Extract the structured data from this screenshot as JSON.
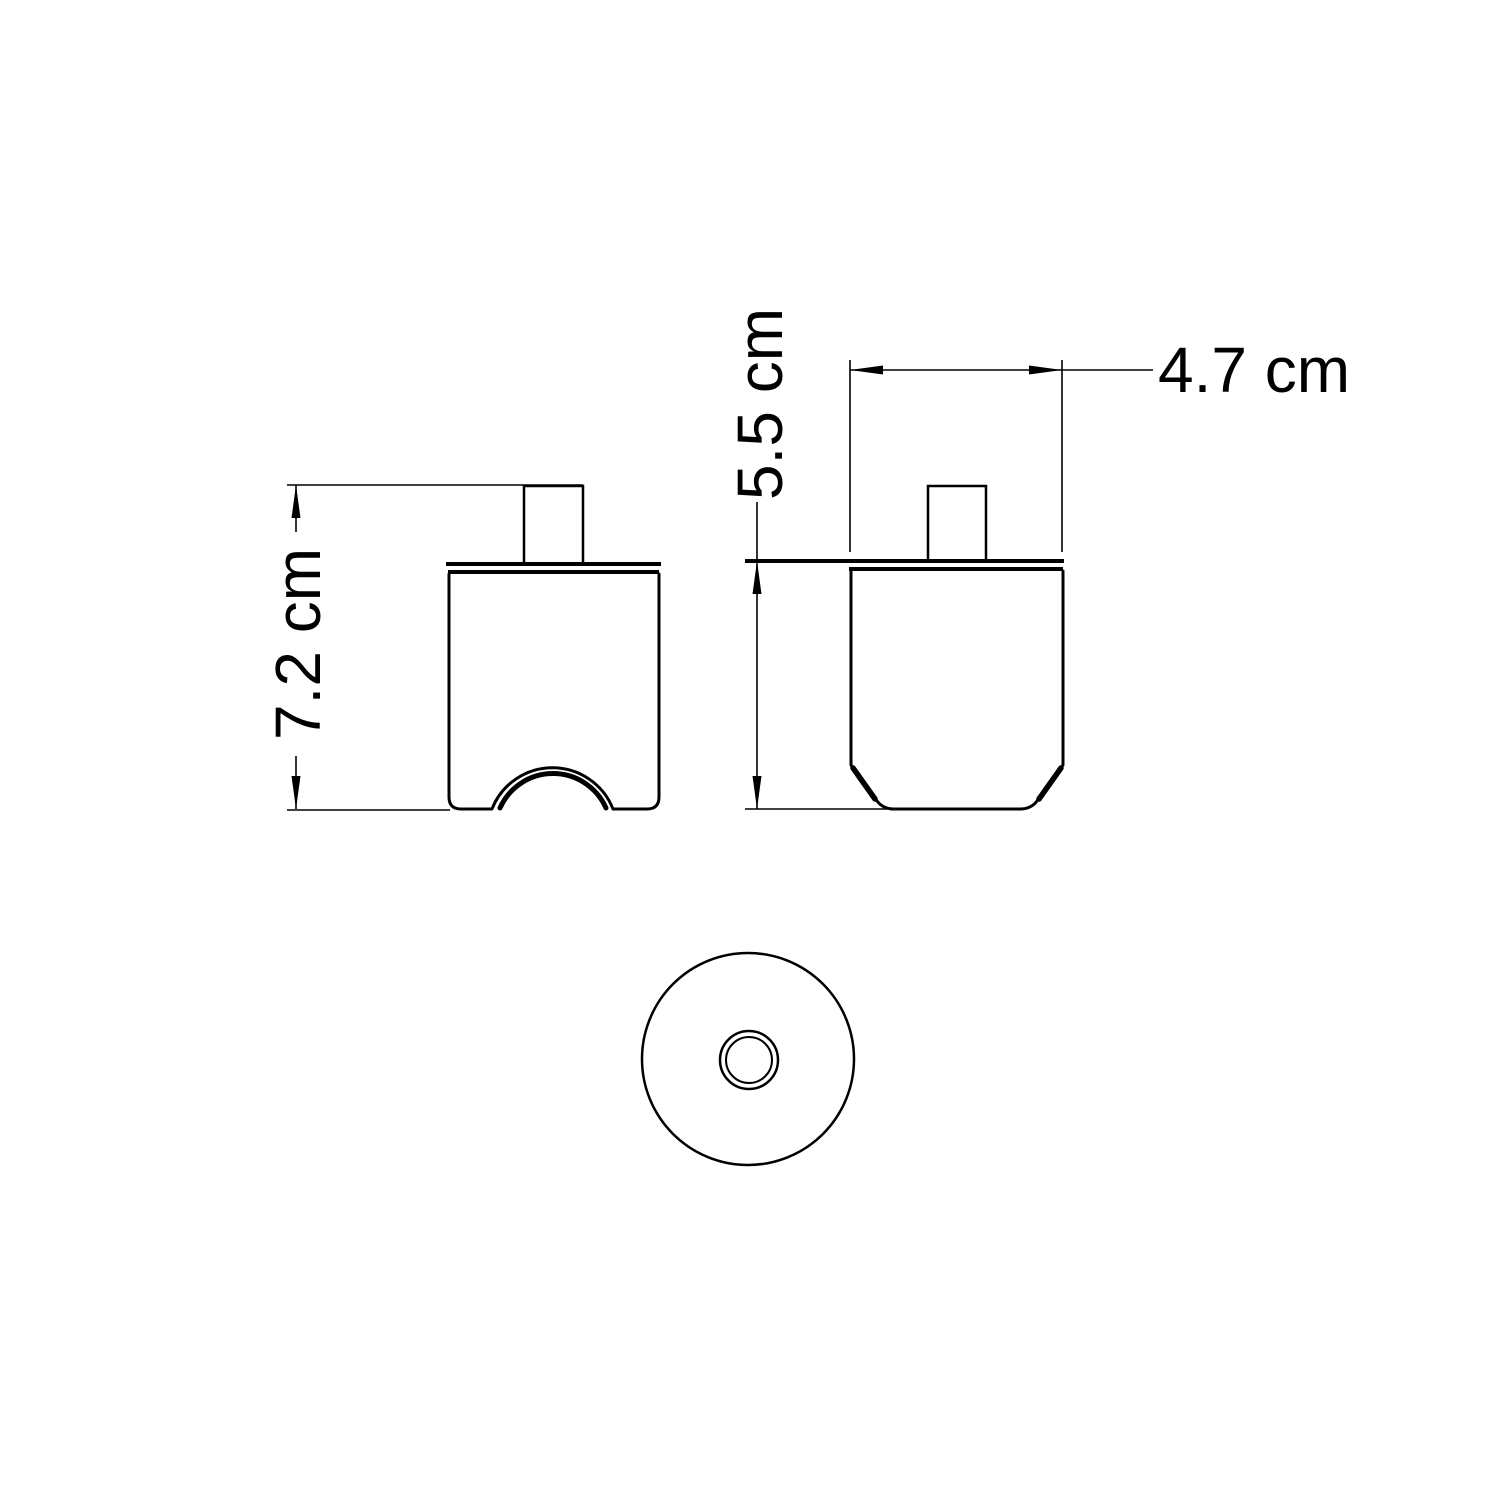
{
  "page": {
    "background": "#ffffff"
  },
  "drawing": {
    "line_color": "#000000",
    "dimensions": {
      "front_height": {
        "label": "7.2 cm",
        "value_cm": 7.2
      },
      "side_height": {
        "label": "5.5 cm",
        "value_cm": 5.5
      },
      "side_width": {
        "label": "4.7 cm",
        "value_cm": 4.7
      }
    }
  }
}
